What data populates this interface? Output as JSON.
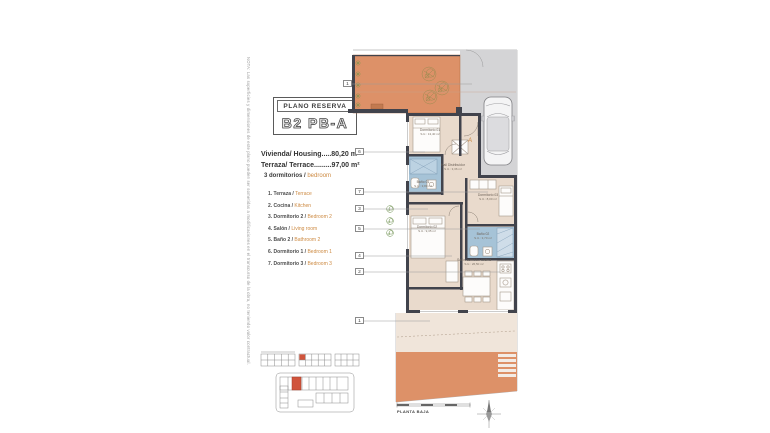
{
  "note": "NOTA: Las superficies y dimensiones de este plano pueden ser sometidas a modificaciones en el transcurso de la obra, no teniendo valor contractual.",
  "title_block": {
    "label": "PLANO RESERVA",
    "code": "B2 PB-A"
  },
  "areas": {
    "housing": "Vivienda/ Housing.....80,20 m²",
    "terrace": "Terraza/ Terrace.........97,00 m²",
    "bedrooms_es": "3 dormitorios /",
    "bedrooms_en": "bedroom"
  },
  "legend": [
    {
      "es": "1.  Terraza /",
      "en": "Terrace"
    },
    {
      "es": "2.  Cocina /",
      "en": "Kitchen"
    },
    {
      "es": "3.  Dormitorio 2 /",
      "en": "Bedroom 2"
    },
    {
      "es": "4.  Salón /",
      "en": "Living room"
    },
    {
      "es": "5.  Baño 2 /",
      "en": "Bathroom 2"
    },
    {
      "es": "6.  Dormitorio 1 /",
      "en": "Bedroom 1"
    },
    {
      "es": "7.  Dormitorio 3 /",
      "en": "Bedroom 3"
    }
  ],
  "plan": {
    "markers": [
      {
        "n": "1"
      },
      {
        "n": "6"
      },
      {
        "n": "7"
      },
      {
        "n": "3"
      },
      {
        "n": "5"
      },
      {
        "n": "4"
      },
      {
        "n": "2"
      },
      {
        "n": "1"
      }
    ],
    "entrance": "A",
    "rooms": {
      "dorm1": {
        "name": "Dormitorio 01",
        "area": "S.U.: 13,40 m²"
      },
      "bath1": {
        "name": "Baño 01",
        "area": "S.U.: 3,80 m²"
      },
      "hall": {
        "name": "Hall Distribuidor",
        "area": "S.U.: 3,36 m²"
      },
      "dorm3": {
        "name": "Dormitorio 03",
        "area": "S.U.: 8,00 m²"
      },
      "dorm2": {
        "name": "Dormitorio 02",
        "area": "S.U.: 9,35 m²"
      },
      "bath2": {
        "name": "Baño 02",
        "area": "S.U.: 3,70 m²"
      },
      "salon": {
        "name": "Salón-comedor-cocina",
        "area": "S.U.: 26,50 m²"
      }
    },
    "footer": "PLANTA BAJA"
  },
  "colors": {
    "accent_orange": "#cd8a42",
    "terrace": "#dd9168",
    "interior": "#e9dacc",
    "terrace_light": "#f0e5da",
    "bathroom_blue": "#a6c3d7",
    "paving_gray": "#d4d4d6",
    "wall_dark": "#41434c",
    "highlight_red": "#d0543c"
  }
}
